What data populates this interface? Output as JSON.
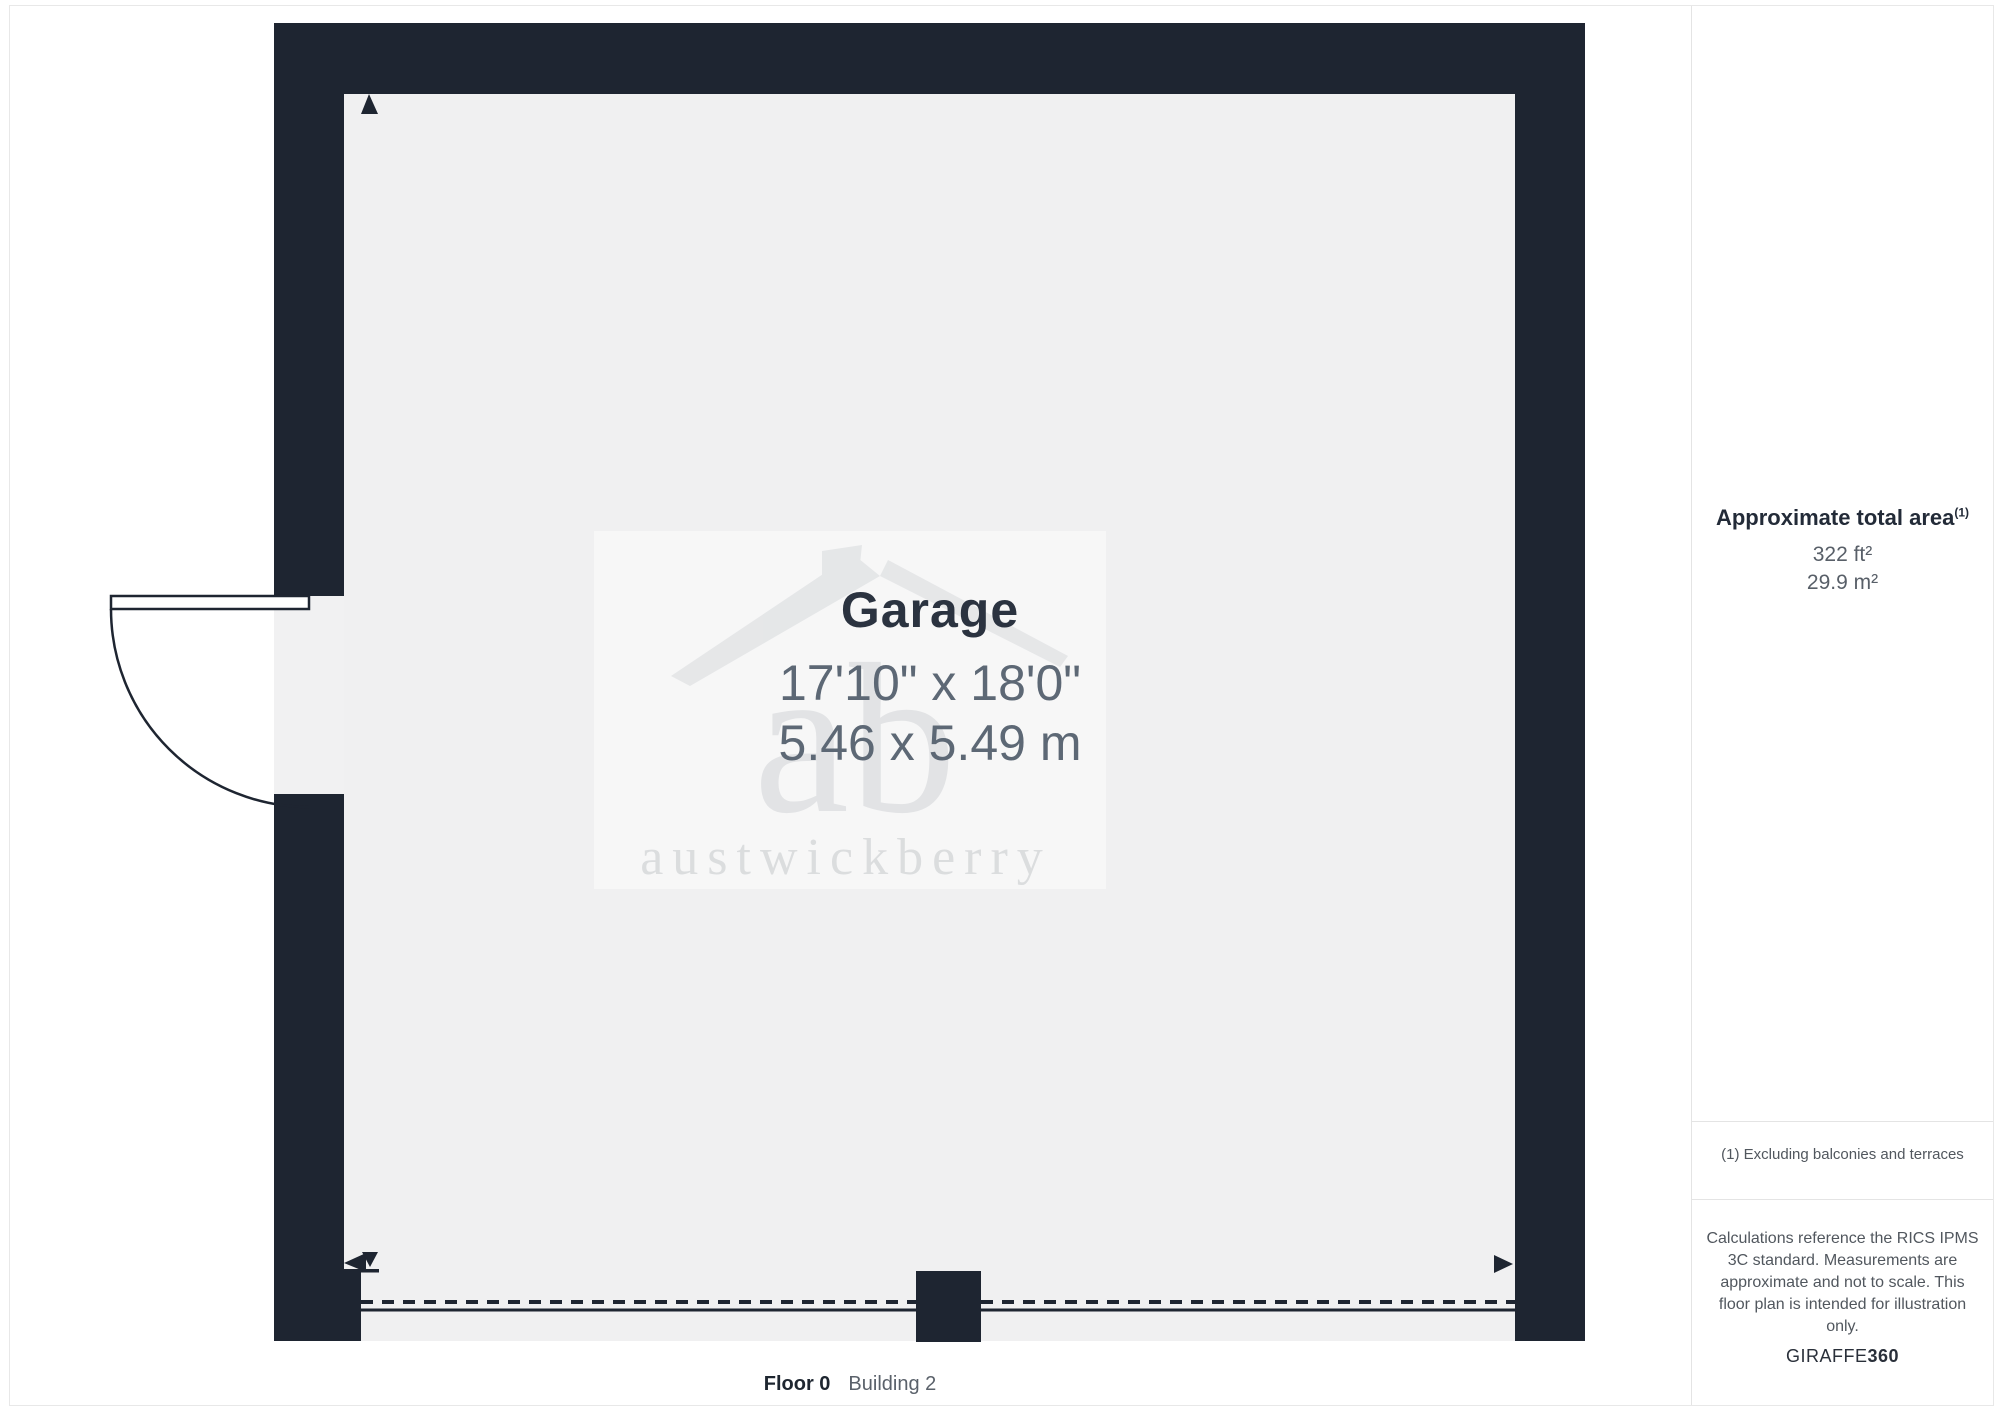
{
  "plan": {
    "room": {
      "name": "Garage",
      "dims_imperial": "17'10\" x 18'0\"",
      "dims_metric": "5.46 x 5.49 m"
    },
    "floor_label": "Floor 0",
    "building_label": "Building 2"
  },
  "watermark": {
    "monogram": "ab",
    "name": "austwickberry"
  },
  "sidebar": {
    "area_heading": "Approximate total area",
    "area_sup": "(1)",
    "area_ft": "322 ft²",
    "area_m": "29.9 m²",
    "footnote": "(1) Excluding balconies and terraces",
    "disclaimer": "Calculations reference the RICS IPMS 3C standard. Measurements are approximate and not to scale. This floor plan is intended for illustration only.",
    "brand": "GIRAFFE",
    "brand_suffix": "360"
  },
  "colors": {
    "wall": "#1e2531",
    "floor": "#f0f0f1",
    "room_name_text": "#2b3340",
    "dims_text": "#5d6875",
    "watermark_gray": "#c6c9cc"
  }
}
